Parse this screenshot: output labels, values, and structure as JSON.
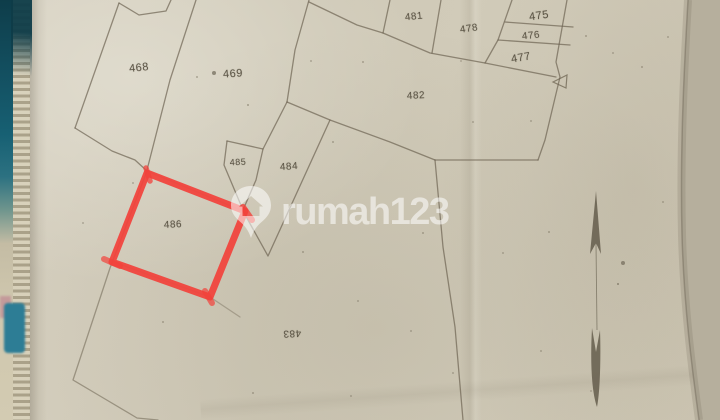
{
  "photo_subject": "hand-drawn cadastral site plan photographed on a clipboard",
  "map": {
    "parcels": [
      {
        "id": "468",
        "x": 139,
        "y": 68,
        "size": 11,
        "rot": -6
      },
      {
        "id": "469",
        "x": 233,
        "y": 74,
        "size": 11,
        "rot": -4
      },
      {
        "id": "481",
        "x": 414,
        "y": 17,
        "size": 10,
        "rot": -6
      },
      {
        "id": "478",
        "x": 469,
        "y": 29,
        "size": 10,
        "rot": -8
      },
      {
        "id": "475",
        "x": 539,
        "y": 16,
        "size": 11,
        "rot": -8
      },
      {
        "id": "476",
        "x": 531,
        "y": 36,
        "size": 10,
        "rot": -6
      },
      {
        "id": "477",
        "x": 521,
        "y": 58,
        "size": 11,
        "rot": -10
      },
      {
        "id": "482",
        "x": 416,
        "y": 96,
        "size": 10,
        "rot": -3
      },
      {
        "id": "485",
        "x": 238,
        "y": 162,
        "size": 9,
        "rot": -3
      },
      {
        "id": "484",
        "x": 289,
        "y": 167,
        "size": 10,
        "rot": -4
      },
      {
        "id": "486",
        "x": 173,
        "y": 225,
        "size": 10,
        "rot": -3
      },
      {
        "id": "483",
        "x": 292,
        "y": 333,
        "size": 10,
        "rot": 177
      }
    ],
    "highlighted_parcel_id": "486",
    "highlight_color": "#f2413b",
    "pencil_color": "#6d6452",
    "north_arrow": "present, pointing up"
  },
  "watermark": {
    "text": "rumah123",
    "logo": "map-pin-with-house",
    "color_rgba": "rgba(255,255,255,0.55)"
  },
  "colors": {
    "paper": "#cfc8b6",
    "paper_edge_right": "#b6af9d",
    "binding_teal": "#135061"
  }
}
